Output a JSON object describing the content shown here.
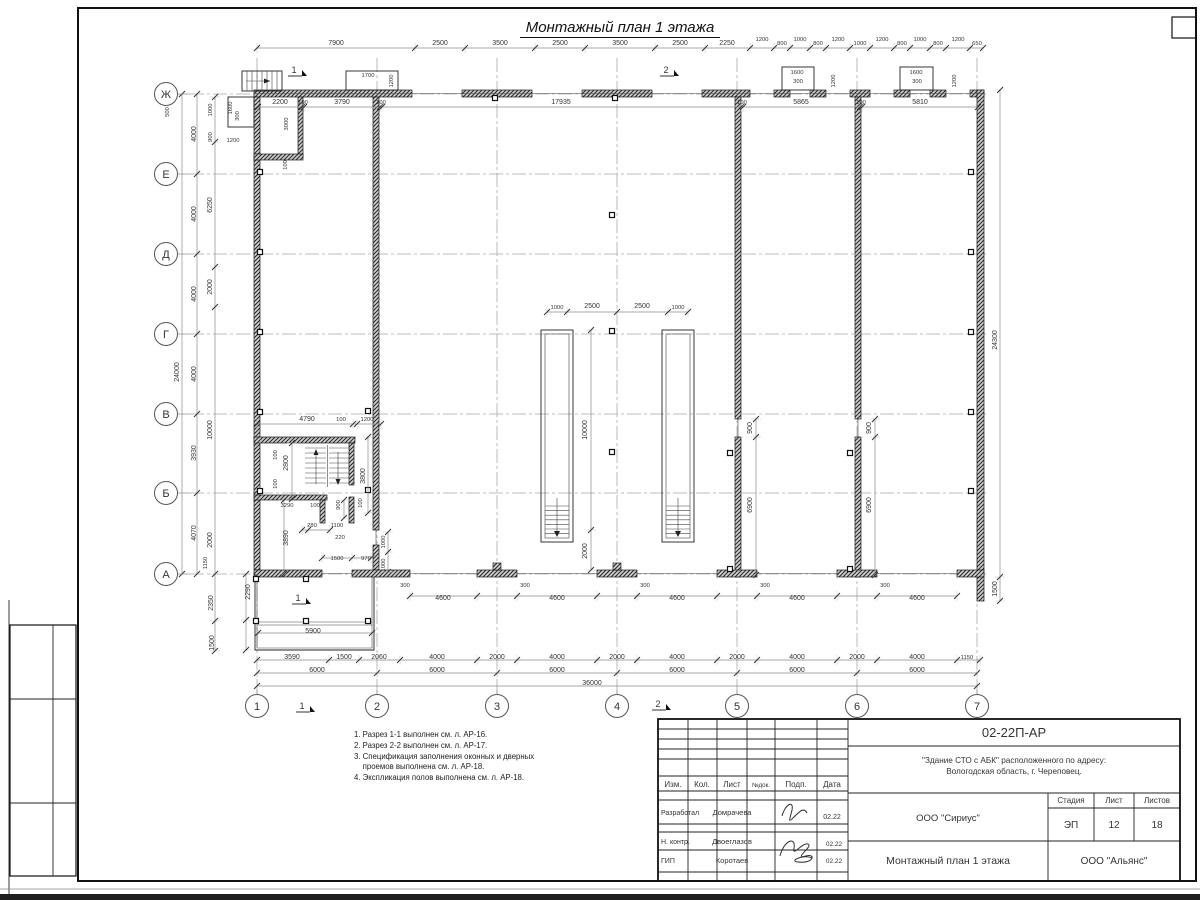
{
  "sheet": {
    "title": "Монтажный план 1 этажа",
    "notes": [
      "1. Разрез 1-1 выполнен см. л. АР-16.",
      "2. Разрез 2-2 выполнен см. л. АР-17.",
      "3. Спецификация заполнения оконных и дверных",
      "    проемов выполнена см. л. АР-18.",
      "4. Экспликация полов выполнена см. л. АР-18."
    ]
  },
  "title_block": {
    "doc_number": "02-22П-АР",
    "project_line1": "\"Здание СТО с АБК\" расположенного по адресу:",
    "project_line2": "Вологодская область, г. Череповец.",
    "header_cols": [
      "Изм.",
      "Кол.",
      "Лист",
      "№док.",
      "Подп.",
      "Дата"
    ],
    "rows": [
      {
        "role": "Разработал",
        "name": "Домрачева",
        "date": "02.22"
      },
      {
        "role": "Н. контр.",
        "name": "Двоеглазов",
        "date": "02.22"
      },
      {
        "role": "ГИП",
        "name": "Коротаев",
        "date": "02.22"
      }
    ],
    "org_center": "ООО \"Сириус\"",
    "stage_label": "Стадия",
    "sheet_label": "Лист",
    "sheets_label": "Листов",
    "stage": "ЭП",
    "sheet_no": "12",
    "sheets_total": "18",
    "drawing_title": "Монтажный план 1 этажа",
    "org_right": "ООО \"Альянс\""
  },
  "plan": {
    "row_axes": [
      [
        "Ж",
        94
      ],
      [
        "Е",
        174
      ],
      [
        "Д",
        254
      ],
      [
        "Г",
        334
      ],
      [
        "В",
        414
      ],
      [
        "Б",
        493
      ],
      [
        "А",
        574
      ]
    ],
    "col_axes": [
      [
        "1",
        257
      ],
      [
        "2",
        377
      ],
      [
        "3",
        497
      ],
      [
        "4",
        617
      ],
      [
        "5",
        737
      ],
      [
        "6",
        857
      ],
      [
        "7",
        977
      ]
    ],
    "section_marks": [
      [
        "1",
        294,
        73
      ],
      [
        "1",
        298,
        601
      ],
      [
        "1",
        302,
        709
      ],
      [
        "2",
        666,
        73
      ],
      [
        "2",
        658,
        707
      ]
    ],
    "dim_labels": [
      [
        "7900",
        336,
        45,
        ""
      ],
      [
        "2500",
        440,
        45,
        ""
      ],
      [
        "3500",
        500,
        45,
        ""
      ],
      [
        "2500",
        560,
        45,
        ""
      ],
      [
        "3500",
        620,
        45,
        ""
      ],
      [
        "2500",
        680,
        45,
        ""
      ],
      [
        "2250",
        727,
        45,
        ""
      ],
      [
        "1200",
        762,
        41,
        "s"
      ],
      [
        "800",
        782,
        45,
        "s"
      ],
      [
        "1000",
        800,
        41,
        "s"
      ],
      [
        "800",
        818,
        45,
        "s"
      ],
      [
        "1200",
        838,
        41,
        "s"
      ],
      [
        "1000",
        860,
        45,
        "s"
      ],
      [
        "1200",
        882,
        41,
        "s"
      ],
      [
        "800",
        902,
        45,
        "s"
      ],
      [
        "1000",
        920,
        41,
        "s"
      ],
      [
        "800",
        938,
        45,
        "s"
      ],
      [
        "1200",
        958,
        41,
        "s"
      ],
      [
        "650",
        977,
        45,
        "s"
      ],
      [
        "2200",
        280,
        104,
        ""
      ],
      [
        "100",
        303,
        104,
        "s"
      ],
      [
        "3790",
        342,
        104,
        ""
      ],
      [
        "100",
        381,
        104,
        "s"
      ],
      [
        "17935",
        561,
        104,
        ""
      ],
      [
        "100",
        742,
        104,
        "s"
      ],
      [
        "5865",
        801,
        104,
        ""
      ],
      [
        "100",
        861,
        104,
        "s"
      ],
      [
        "5810",
        920,
        104,
        ""
      ],
      [
        "1700",
        368,
        77,
        "s"
      ],
      [
        "1200",
        393,
        81,
        "rs"
      ],
      [
        "1600",
        797,
        74,
        "s"
      ],
      [
        "300",
        798,
        83,
        "s"
      ],
      [
        "1200",
        835,
        81,
        "rs"
      ],
      [
        "1600",
        916,
        74,
        "s"
      ],
      [
        "300",
        917,
        83,
        "s"
      ],
      [
        "1200",
        956,
        81,
        "rs"
      ],
      [
        "500",
        169,
        112,
        "rs"
      ],
      [
        "1000",
        212,
        110,
        "rs"
      ],
      [
        "900",
        212,
        137,
        "rs"
      ],
      [
        "1600",
        232,
        108,
        "rs"
      ],
      [
        "300",
        239,
        116,
        "rs"
      ],
      [
        "1200",
        233,
        142,
        "s"
      ],
      [
        "3000",
        288,
        124,
        "rs"
      ],
      [
        "100",
        287,
        165,
        "rs"
      ],
      [
        "6250",
        212,
        205,
        "r"
      ],
      [
        "2000",
        212,
        287,
        "r"
      ],
      [
        "4000",
        196,
        134,
        "r"
      ],
      [
        "4000",
        196,
        214,
        "r"
      ],
      [
        "4000",
        196,
        294,
        "r"
      ],
      [
        "4000",
        196,
        374,
        "r"
      ],
      [
        "3930",
        196,
        453,
        "r"
      ],
      [
        "4070",
        196,
        533,
        "r"
      ],
      [
        "24000",
        179,
        372,
        "r"
      ],
      [
        "10000",
        212,
        430,
        "r"
      ],
      [
        "2000",
        212,
        540,
        "r"
      ],
      [
        "1150",
        207,
        563,
        "rs"
      ],
      [
        "2350",
        213,
        603,
        "r"
      ],
      [
        "1500",
        214,
        643,
        "r"
      ],
      [
        "4790",
        307,
        421,
        ""
      ],
      [
        "100",
        341,
        421,
        "s"
      ],
      [
        "1200",
        367,
        421,
        "s"
      ],
      [
        "100",
        277,
        455,
        "rs"
      ],
      [
        "2800",
        288,
        463,
        "r"
      ],
      [
        "100",
        277,
        484,
        "rs"
      ],
      [
        "3290",
        287,
        507,
        "s"
      ],
      [
        "100",
        315,
        507,
        "s"
      ],
      [
        "3800",
        365,
        476,
        "r"
      ],
      [
        "100",
        362,
        503,
        "rs"
      ],
      [
        "900",
        340,
        505,
        "rs"
      ],
      [
        "280",
        312,
        527,
        "s"
      ],
      [
        "1100",
        337,
        527,
        "s"
      ],
      [
        "220",
        340,
        539,
        "s"
      ],
      [
        "3890",
        288,
        538,
        "r"
      ],
      [
        "1000",
        385,
        542,
        "rs"
      ],
      [
        "1000",
        385,
        565,
        "rs"
      ],
      [
        "1500",
        337,
        560,
        "s"
      ],
      [
        "970",
        366,
        560,
        "s"
      ],
      [
        "1000",
        557,
        309,
        "s"
      ],
      [
        "2500",
        592,
        308,
        ""
      ],
      [
        "2500",
        642,
        308,
        ""
      ],
      [
        "1000",
        678,
        309,
        "s"
      ],
      [
        "10000",
        587,
        430,
        "r"
      ],
      [
        "2000",
        587,
        551,
        "r"
      ],
      [
        "900",
        752,
        428,
        "r"
      ],
      [
        "6900",
        752,
        505,
        "r"
      ],
      [
        "900",
        871,
        428,
        "r"
      ],
      [
        "6900",
        871,
        505,
        "r"
      ],
      [
        "24300",
        997,
        340,
        "r"
      ],
      [
        "1500",
        997,
        589,
        "r"
      ],
      [
        "300",
        405,
        587,
        "s"
      ],
      [
        "300",
        525,
        587,
        "s"
      ],
      [
        "300",
        645,
        587,
        "s"
      ],
      [
        "300",
        765,
        587,
        "s"
      ],
      [
        "300",
        885,
        587,
        "s"
      ],
      [
        "4600",
        443,
        600,
        ""
      ],
      [
        "4600",
        557,
        600,
        ""
      ],
      [
        "4600",
        677,
        600,
        ""
      ],
      [
        "4600",
        797,
        600,
        ""
      ],
      [
        "4600",
        917,
        600,
        ""
      ],
      [
        "3590",
        292,
        659,
        ""
      ],
      [
        "1500",
        344,
        659,
        ""
      ],
      [
        "2060",
        379,
        659,
        ""
      ],
      [
        "4000",
        437,
        659,
        ""
      ],
      [
        "2000",
        497,
        659,
        ""
      ],
      [
        "4000",
        557,
        659,
        ""
      ],
      [
        "2000",
        617,
        659,
        ""
      ],
      [
        "4000",
        677,
        659,
        ""
      ],
      [
        "2000",
        737,
        659,
        ""
      ],
      [
        "4000",
        797,
        659,
        ""
      ],
      [
        "2000",
        857,
        659,
        ""
      ],
      [
        "4000",
        917,
        659,
        ""
      ],
      [
        "1150",
        967,
        659,
        "s"
      ],
      [
        "6000",
        317,
        672,
        ""
      ],
      [
        "6000",
        437,
        672,
        ""
      ],
      [
        "6000",
        557,
        672,
        ""
      ],
      [
        "6000",
        677,
        672,
        ""
      ],
      [
        "6000",
        797,
        672,
        ""
      ],
      [
        "6000",
        917,
        672,
        ""
      ],
      [
        "36000",
        592,
        685,
        ""
      ],
      [
        "2290",
        250,
        592,
        "r"
      ],
      [
        "5900",
        313,
        633,
        ""
      ]
    ]
  }
}
